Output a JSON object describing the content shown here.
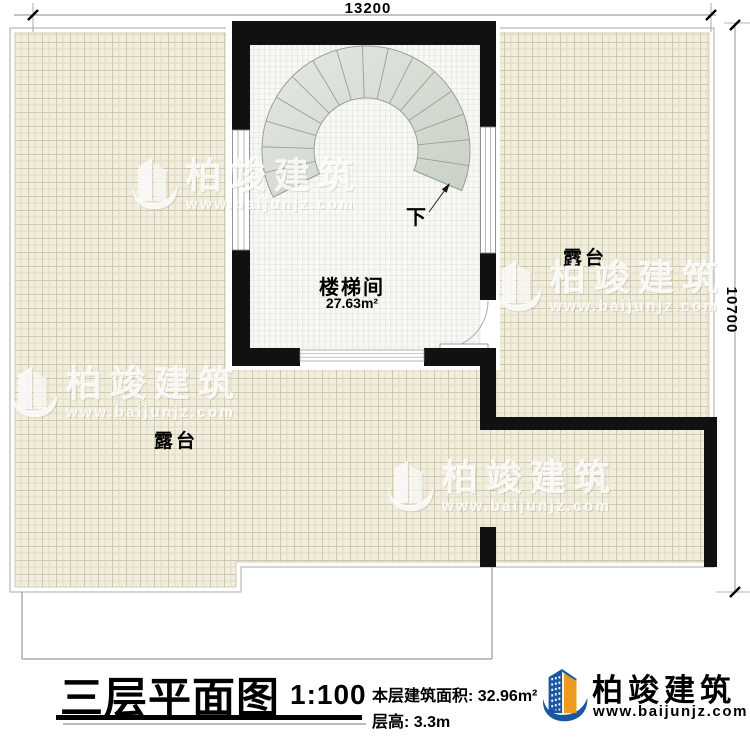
{
  "plan": {
    "dimensions": {
      "top": "13200",
      "right": "10700"
    },
    "stairwell": {
      "name": "楼梯间",
      "area": "27.63m²",
      "direction": "下"
    },
    "terrace_right": "露台",
    "terrace_left": "露台",
    "watermark": {
      "name": "柏竣建筑",
      "url": "www.baijunjz.com"
    }
  },
  "title_block": {
    "title": "三层平面图",
    "scale": "1:100",
    "area_label": "本层建筑面积: 32.96m²",
    "height_label": "层高: 3.3m",
    "brand": {
      "name": "柏竣建筑",
      "url": "www.baijunjz.com"
    }
  },
  "colors": {
    "wall": "#111111",
    "tile": "#f1eedd",
    "stair_tread": "#dce1d8",
    "brand_blue": "#1b57a0",
    "brand_orange": "#ee9a1f"
  }
}
